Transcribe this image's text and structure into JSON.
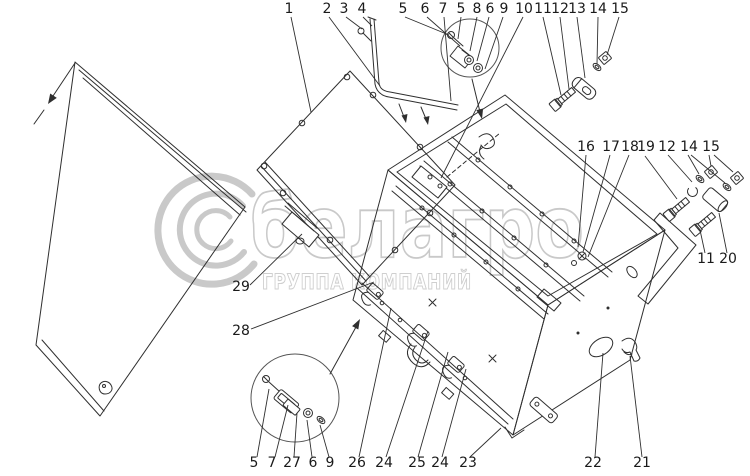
{
  "page": {
    "background": "#ffffff"
  },
  "diagram": {
    "type": "exploded-parts-drawing",
    "line_color": "#2f2f2f",
    "label_color": "#1a1a1a",
    "watermark": {
      "color": "#c9c9c9",
      "brand": "белагро",
      "subtitle": "ГРУППА КОМПАНИЙ",
      "logo": "c-swirl-logo"
    },
    "callouts": [
      {
        "label": "1",
        "x": 289,
        "y": 13,
        "leaders": [
          [
            291,
            17,
            311,
            112
          ]
        ]
      },
      {
        "label": "2",
        "x": 327,
        "y": 13,
        "leaders": [
          [
            329,
            17,
            380,
            86
          ]
        ]
      },
      {
        "label": "3",
        "x": 344,
        "y": 13,
        "leaders": [
          [
            346,
            17,
            362,
            29
          ]
        ]
      },
      {
        "label": "4",
        "x": 362,
        "y": 13,
        "leaders": [
          [
            363,
            17,
            372,
            26
          ]
        ]
      },
      {
        "label": "5",
        "x": 403,
        "y": 13,
        "leaders": [
          [
            405,
            17,
            449,
            35
          ]
        ]
      },
      {
        "label": "6",
        "x": 425,
        "y": 13,
        "leaders": [
          [
            427,
            17,
            460,
            46
          ]
        ]
      },
      {
        "label": "7",
        "x": 443,
        "y": 13,
        "leaders": [
          [
            444,
            17,
            451,
            101
          ]
        ]
      },
      {
        "label": "5",
        "x": 461,
        "y": 13,
        "leaders": [
          [
            461,
            17,
            458,
            39
          ]
        ]
      },
      {
        "label": "8",
        "x": 477,
        "y": 13,
        "leaders": [
          [
            477,
            17,
            470,
            51
          ]
        ]
      },
      {
        "label": "6",
        "x": 490,
        "y": 13,
        "leaders": [
          [
            489,
            17,
            477,
            61
          ]
        ]
      },
      {
        "label": "9",
        "x": 504,
        "y": 13,
        "leaders": [
          [
            503,
            17,
            485,
            69
          ]
        ]
      },
      {
        "label": "10",
        "x": 524,
        "y": 13,
        "leaders": [
          [
            523,
            17,
            441,
            178
          ]
        ]
      },
      {
        "label": "11",
        "x": 543,
        "y": 13,
        "leaders": [
          [
            543,
            17,
            561,
            95
          ]
        ]
      },
      {
        "label": "12",
        "x": 560,
        "y": 13,
        "leaders": [
          [
            560,
            17,
            569,
            89
          ]
        ]
      },
      {
        "label": "13",
        "x": 577,
        "y": 13,
        "leaders": [
          [
            577,
            17,
            585,
            78
          ]
        ]
      },
      {
        "label": "14",
        "x": 598,
        "y": 13,
        "leaders": [
          [
            598,
            17,
            597,
            64
          ]
        ]
      },
      {
        "label": "15",
        "x": 620,
        "y": 13,
        "leaders": [
          [
            619,
            17,
            607,
            55
          ]
        ]
      },
      {
        "label": "16",
        "x": 586,
        "y": 151,
        "leaders": [
          [
            586,
            155,
            578,
            247
          ]
        ]
      },
      {
        "label": "17",
        "x": 611,
        "y": 151,
        "leaders": [
          [
            610,
            155,
            583,
            252
          ]
        ]
      },
      {
        "label": "18",
        "x": 630,
        "y": 151,
        "leaders": [
          [
            629,
            155,
            588,
            257
          ]
        ]
      },
      {
        "label": "19",
        "x": 646,
        "y": 151,
        "leaders": [
          [
            645,
            156,
            677,
            199
          ]
        ]
      },
      {
        "label": "12",
        "x": 667,
        "y": 151,
        "leaders": [
          [
            668,
            155,
            692,
            182
          ]
        ]
      },
      {
        "label": "14",
        "x": 689,
        "y": 151,
        "leaders": [
          [
            688,
            155,
            699,
            174
          ],
          [
            691,
            155,
            725,
            183
          ]
        ]
      },
      {
        "label": "15",
        "x": 711,
        "y": 151,
        "leaders": [
          [
            709,
            155,
            711,
            166
          ],
          [
            714,
            155,
            733,
            172
          ]
        ]
      },
      {
        "label": "11",
        "x": 706,
        "y": 263,
        "leaders": [
          [
            705,
            253,
            700,
            230
          ]
        ]
      },
      {
        "label": "20",
        "x": 728,
        "y": 263,
        "leaders": [
          [
            727,
            253,
            719,
            213
          ]
        ]
      },
      {
        "label": "29",
        "x": 241,
        "y": 291,
        "leaders": [
          [
            250,
            285,
            302,
            234
          ]
        ]
      },
      {
        "label": "28",
        "x": 241,
        "y": 335,
        "leaders": [
          [
            251,
            329,
            374,
            282
          ]
        ]
      },
      {
        "label": "5",
        "x": 254,
        "y": 467,
        "leaders": [
          [
            257,
            457,
            269,
            389
          ]
        ]
      },
      {
        "label": "7",
        "x": 272,
        "y": 467,
        "leaders": [
          [
            275,
            457,
            288,
            405
          ]
        ]
      },
      {
        "label": "27",
        "x": 292,
        "y": 467,
        "leaders": [
          [
            294,
            457,
            297,
            413
          ]
        ]
      },
      {
        "label": "6",
        "x": 313,
        "y": 467,
        "leaders": [
          [
            312,
            457,
            307,
            420
          ]
        ]
      },
      {
        "label": "9",
        "x": 330,
        "y": 467,
        "leaders": [
          [
            329,
            457,
            320,
            425
          ]
        ]
      },
      {
        "label": "26",
        "x": 357,
        "y": 467,
        "leaders": [
          [
            359,
            457,
            391,
            308
          ]
        ]
      },
      {
        "label": "24",
        "x": 384,
        "y": 467,
        "leaders": [
          [
            386,
            457,
            428,
            331
          ]
        ]
      },
      {
        "label": "25",
        "x": 417,
        "y": 467,
        "leaders": [
          [
            418,
            457,
            448,
            352
          ]
        ]
      },
      {
        "label": "24",
        "x": 440,
        "y": 467,
        "leaders": [
          [
            442,
            457,
            466,
            369
          ]
        ]
      },
      {
        "label": "23",
        "x": 468,
        "y": 467,
        "leaders": [
          [
            470,
            457,
            501,
            428
          ]
        ]
      },
      {
        "label": "22",
        "x": 593,
        "y": 467,
        "leaders": [
          [
            595,
            457,
            603,
            353
          ]
        ]
      },
      {
        "label": "21",
        "x": 642,
        "y": 467,
        "leaders": [
          [
            642,
            457,
            630,
            356
          ]
        ]
      }
    ]
  }
}
